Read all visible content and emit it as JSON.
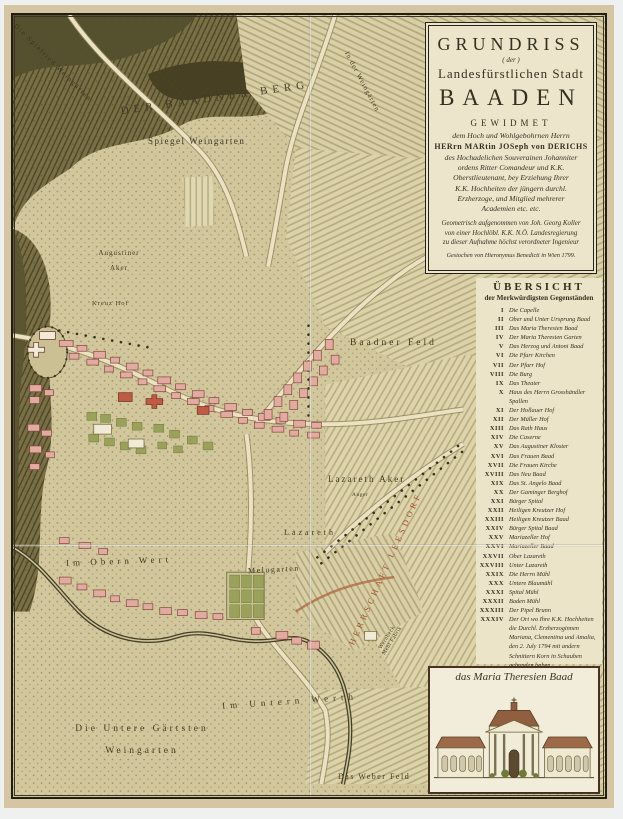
{
  "cartouche": {
    "title_grundriss": "GRUNDRISS",
    "title_der": "( der )",
    "title_stadt": "Landesfürstlichen Stadt",
    "title_baaden": "BAADEN",
    "gewidmet": "GEWIDMET",
    "dedication_intro": "dem Hoch und Wohlgebohrnen Herrn",
    "dedication_name": "HERrn MARtin JOSeph von DERICHS",
    "dedication_body": "des Hochadelichen Souverainen Johanniter\nordens Ritter Comandeur und K.K.\nOberstlieutenant, bey Erziehung Ihrer\nK.K. Hochheiten der jüngern durchl.\nErzherzoge, und Mitglied mehrerer\nAcademien etc. etc.",
    "surveyor_block": "Geometrisch aufgenommen von Joh. Georg Koller\nvon einer Hochlöbl. K.K. N.Ö. Landesregierung\nzu dieser Aufnahme höchst verordneter Ingenieur",
    "imprint": "Gestochen von Hieronymus Benedicti in Wien 1799."
  },
  "legend": {
    "title": "ÜBERSICHT",
    "subtitle": "der Merkwürdigsten Gegenständen",
    "items": [
      {
        "num": "I",
        "label": "Die Capelle"
      },
      {
        "num": "II",
        "label": "Ober und Unter Ursprung Baad"
      },
      {
        "num": "III",
        "label": "Das Maria Theresien Baad"
      },
      {
        "num": "IV",
        "label": "Der Maria Theresien Garten"
      },
      {
        "num": "V",
        "label": "Das Herzog und Antoni Baad"
      },
      {
        "num": "VI",
        "label": "Die Pfarr Kirchen"
      },
      {
        "num": "VII",
        "label": "Der Pfarr Hof"
      },
      {
        "num": "VIII",
        "label": "Die Burg"
      },
      {
        "num": "IX",
        "label": "Das Theater"
      },
      {
        "num": "X",
        "label": "Haus des Herrn Grosshändler Spallen"
      },
      {
        "num": "XI",
        "label": "Der Hollauer Hof"
      },
      {
        "num": "XII",
        "label": "Der Müller Hof"
      },
      {
        "num": "XIII",
        "label": "Das Rath Haus"
      },
      {
        "num": "XIV",
        "label": "Die Caserne"
      },
      {
        "num": "XV",
        "label": "Das Augustiner Kloster"
      },
      {
        "num": "XVI",
        "label": "Das Frauen Baad"
      },
      {
        "num": "XVII",
        "label": "Die Frauen Kirche"
      },
      {
        "num": "XVIII",
        "label": "Das Neu Baad"
      },
      {
        "num": "XIX",
        "label": "Das St. Angelo Baad"
      },
      {
        "num": "XX",
        "label": "Der Gaminger Berghof"
      },
      {
        "num": "XXI",
        "label": "Bürger Spital"
      },
      {
        "num": "XXII",
        "label": "Heiligen Kreutzer Hof"
      },
      {
        "num": "XXIII",
        "label": "Heiligen Kreutzer Baad"
      },
      {
        "num": "XXIV",
        "label": "Bürger Spital Baad"
      },
      {
        "num": "XXV",
        "label": "Mariazeller Hof"
      },
      {
        "num": "XXVI",
        "label": "Mariazeller Baad"
      },
      {
        "num": "XXVII",
        "label": "Ober Lazareth"
      },
      {
        "num": "XXVIII",
        "label": "Unter Lazareth"
      },
      {
        "num": "XXIX",
        "label": "Die Herrn Mühl"
      },
      {
        "num": "XXX",
        "label": "Untere Blaumühl"
      },
      {
        "num": "XXXI",
        "label": "Spital Mühl"
      },
      {
        "num": "XXXII",
        "label": "Baden Mühl"
      },
      {
        "num": "XXXIII",
        "label": "Der Pipel Brunn"
      },
      {
        "num": "XXXIV",
        "label": "Der Ort wo Ihre K.K. Hochheiten die Durchl. Erzherzoginnen Mariana, Clementina und Amalia, den 2. July 1794 mit andern Schnittern Korn in Schauben gebunden haben."
      }
    ]
  },
  "inset": {
    "caption": "das Maria Theresien Baad"
  },
  "map": {
    "labels": [
      {
        "text": "Die Spielried Weingärten"
      },
      {
        "text": "DER BAADNER BERG"
      },
      {
        "text": "Spiegel Weingarten"
      },
      {
        "text": "In der Weingärten"
      },
      {
        "text": "Augustiner\nAker"
      },
      {
        "text": "Kreuz Hof"
      },
      {
        "text": "Baadner Feld"
      },
      {
        "text": "Lazareth Aker"
      },
      {
        "text": "Anger"
      },
      {
        "text": "Lazareth"
      },
      {
        "text": "Im Obern Wert"
      },
      {
        "text": "Melugarten"
      },
      {
        "text": "Im Untern Werth"
      },
      {
        "text": "Die Untere Gärtsten\nWeingarten"
      },
      {
        "text": "Das Weber Feld"
      },
      {
        "text": "Wernbeck\nMehl Fabrik"
      },
      {
        "text": "HERRSCHAFT LEESDORF"
      }
    ],
    "colors": {
      "parchment": "#d2c79c",
      "hill": "#6e6539",
      "building": "#e2aba1",
      "landmark": "#bf5a43",
      "garden": "#9aa15a",
      "river": "#433e26",
      "herrschaft_text": "#a0522d"
    }
  }
}
